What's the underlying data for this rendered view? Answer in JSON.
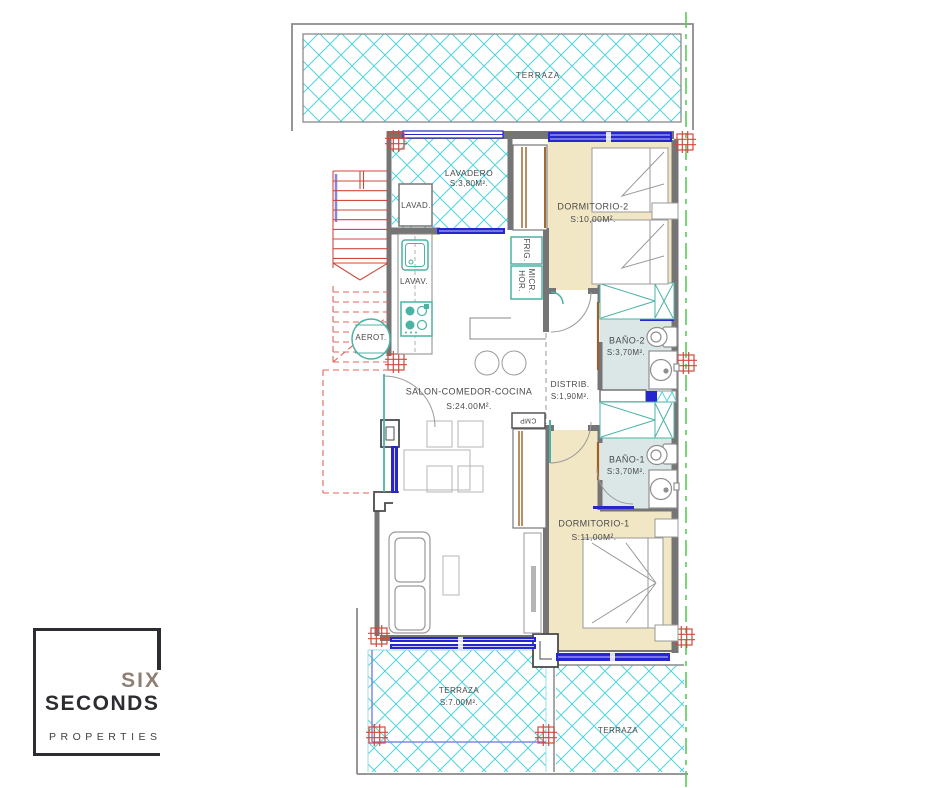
{
  "brand": {
    "name_top": "SIX",
    "name_bottom": "SECONDS",
    "tagline": "PROPERTIES"
  },
  "floorplan": {
    "terraza_top": {
      "label": "TERRAZA"
    },
    "lavadero": {
      "label": "LAVADERO",
      "area": "S:3,80M²."
    },
    "dormitorio_2": {
      "label": "DORMITORIO-2",
      "area": "S:10,00M²."
    },
    "bano_2": {
      "label": "BAÑO-2",
      "area": "S:3,70M²."
    },
    "distribuidor": {
      "label": "DISTRIB.",
      "area": "S:1,90M²."
    },
    "salon": {
      "label": "SALON-COMEDOR-COCINA",
      "area": "S:24.00M²."
    },
    "bano_1": {
      "label": "BAÑO-1",
      "area": "S:3,70M²."
    },
    "dormitorio_1": {
      "label": "DORMITORIO-1",
      "area": "S:11,00M²."
    },
    "terraza_inferior": {
      "label": "TERRAZA",
      "area": "S:7.00M²."
    },
    "terraza_lateral": {
      "label": "TERRAZA"
    },
    "equipment": {
      "lavadora": "LAVAD.",
      "lavavajillas": "LAVAV.",
      "aerotermia": "AEROT.",
      "frigorifico": "FRIG.",
      "horno": "HOR.",
      "microondas": "MICR.",
      "armario_empotrado": "CMP"
    }
  },
  "colors": {
    "hatch_cyan": "#4fd4e0",
    "bedroom_floor": "#f2e7c4",
    "bathroom_floor": "#dbe7e7",
    "window_blue": "#2626cf",
    "wall_gray": "#757575",
    "structure_red": "#cf4a3e",
    "boundary_green": "#58cb58",
    "fixture_teal": "#4bb3a4",
    "logo_dark": "#2e2b33",
    "logo_taupe": "#8d7f74"
  }
}
